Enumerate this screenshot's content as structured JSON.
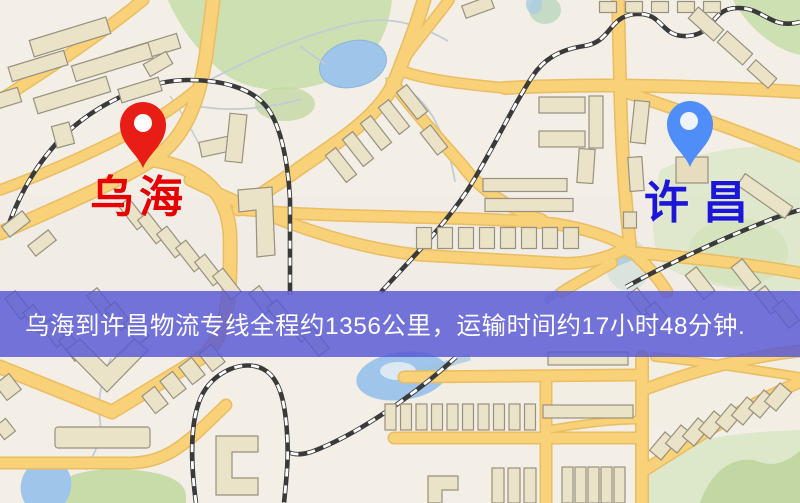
{
  "page": {
    "type": "street-map-with-route-banner"
  },
  "map": {
    "origin_marker": {
      "label": "乌海",
      "pin_color": "#e81d15",
      "label_color": "#e60000"
    },
    "destination_marker": {
      "label": "许昌",
      "pin_color": "#4f8df8",
      "label_color": "#1c16d8"
    }
  },
  "banner": {
    "text": "乌海到许昌物流专线全程约1356公里，运输时间约17小时48分钟.",
    "background_rgba": "rgba(88,88,213,0.83)",
    "text_color": "#ffffff"
  },
  "route": {
    "origin": "乌海",
    "destination": "许昌",
    "distance_text": "约1356公里",
    "duration_text": "约17小时48分钟"
  }
}
